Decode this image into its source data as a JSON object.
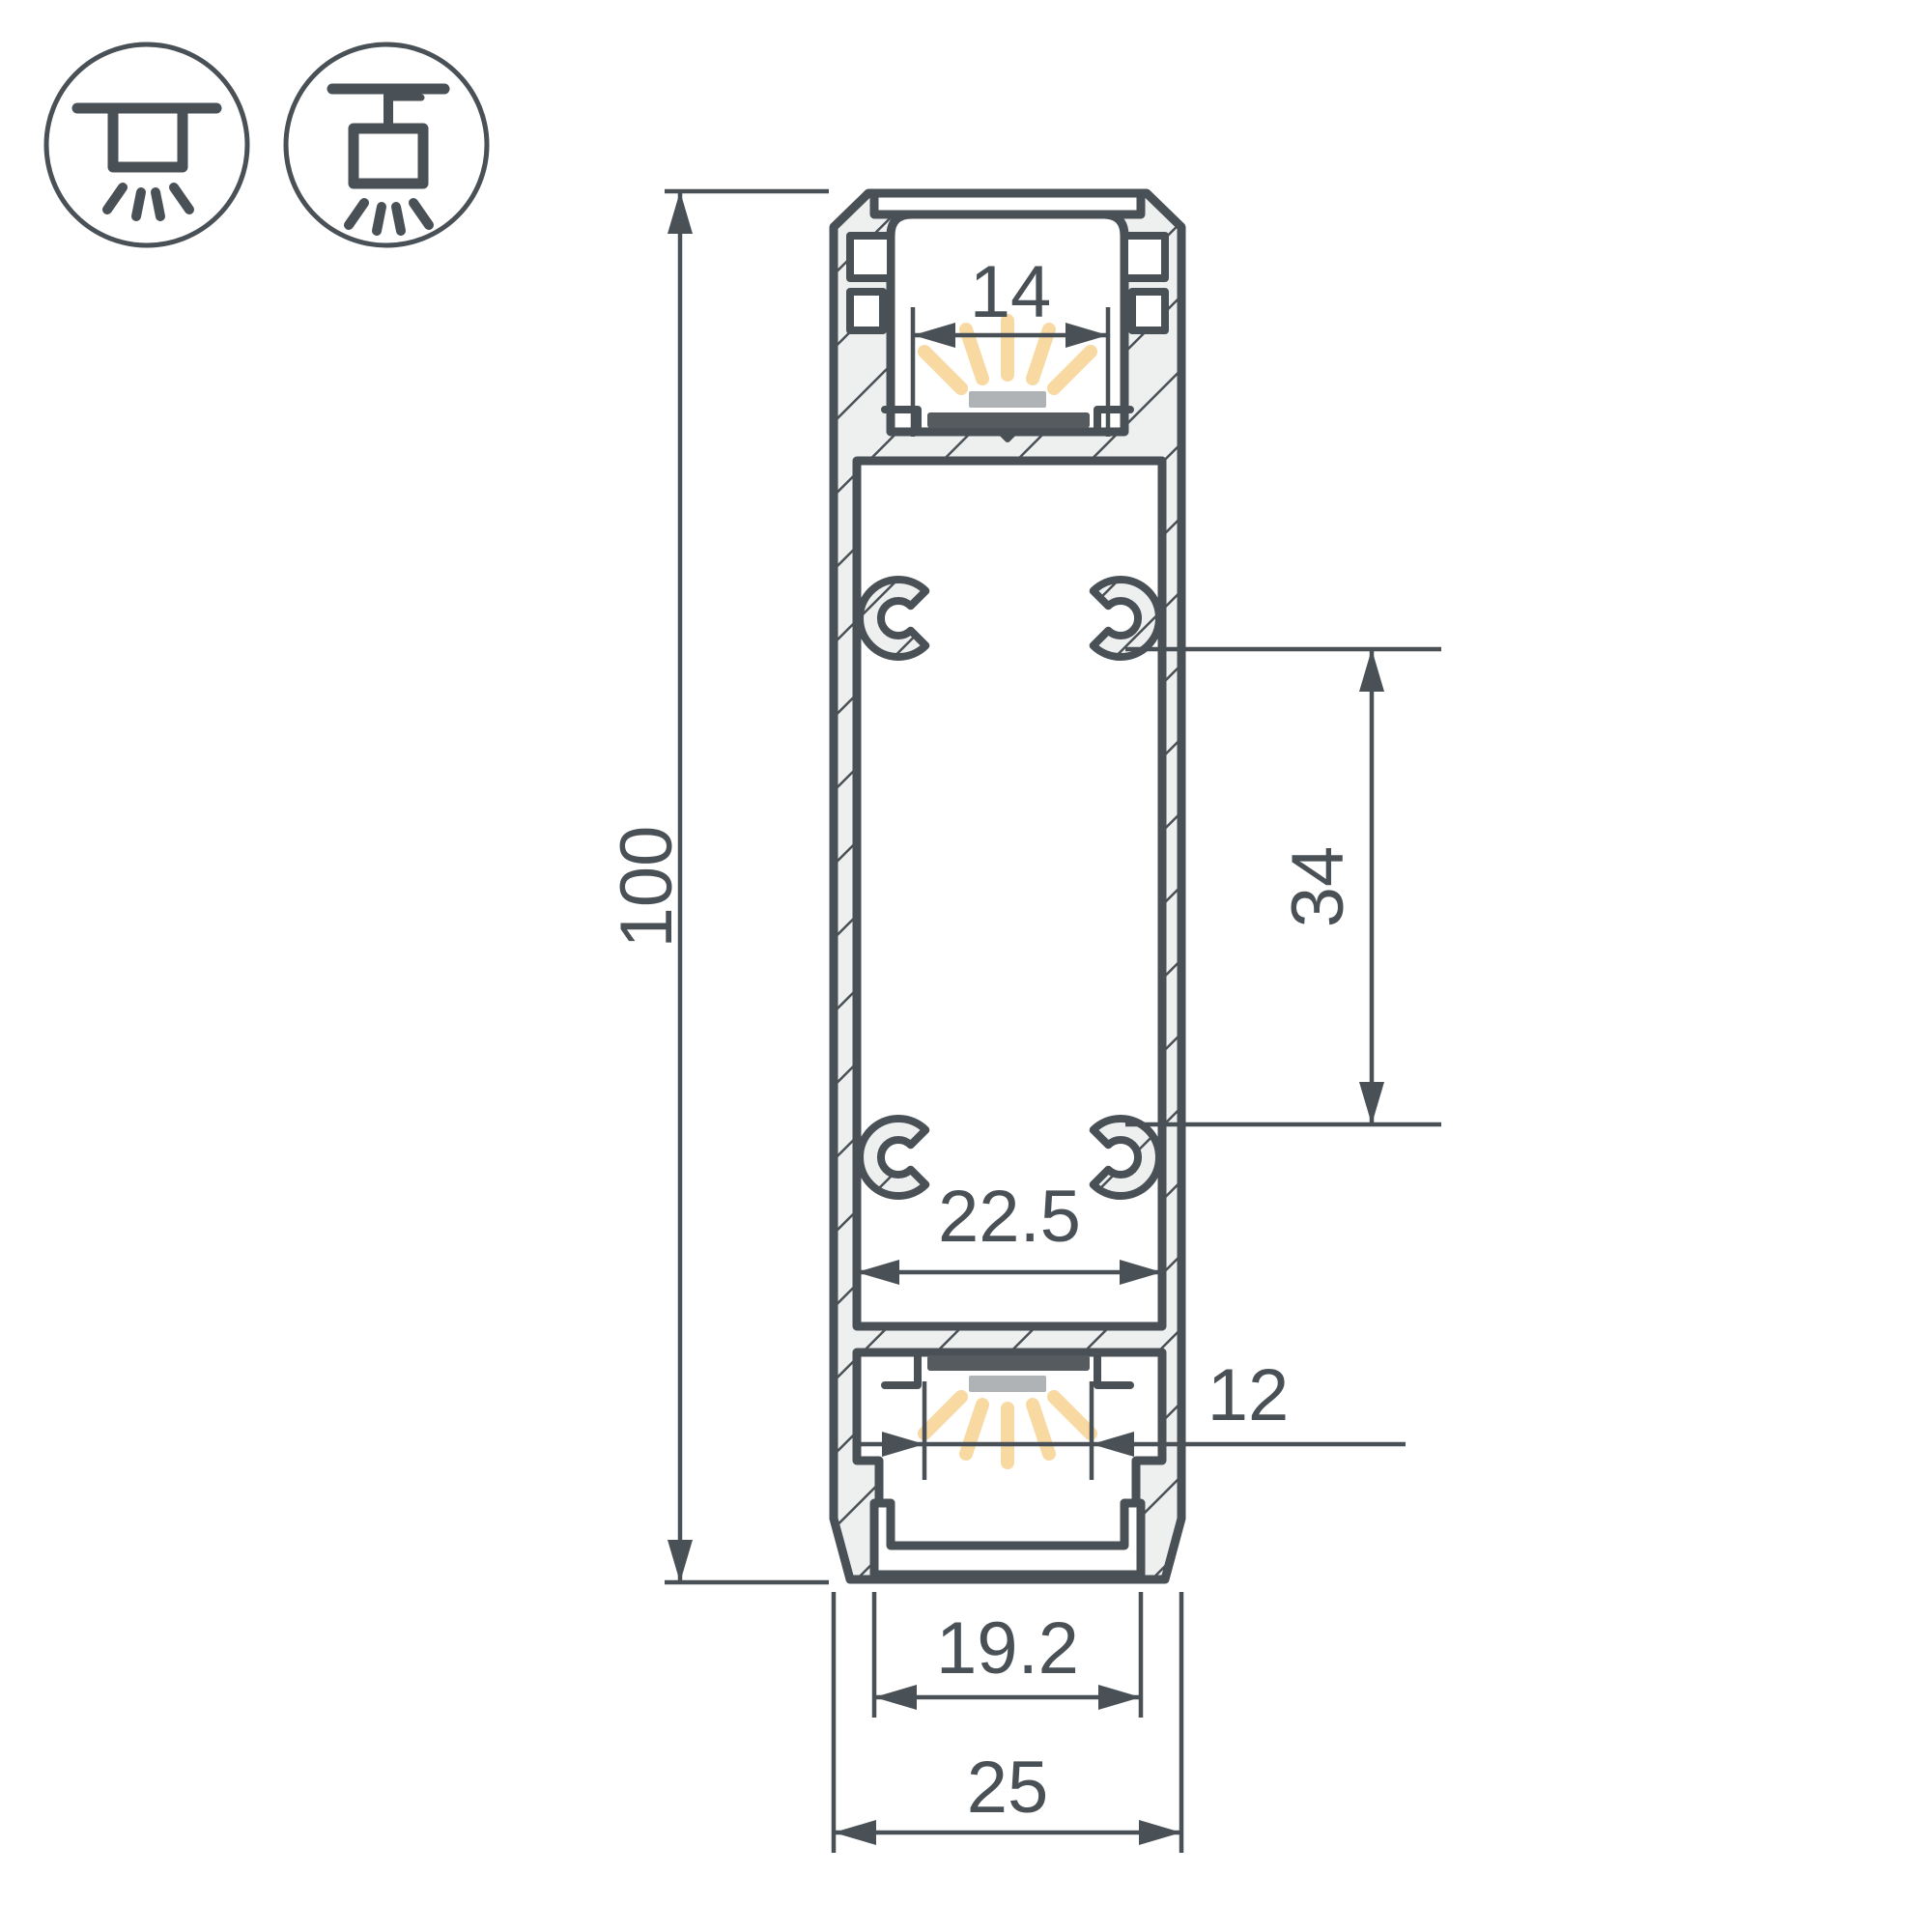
{
  "title": "LED profile cross-section dimension drawing",
  "icons": {
    "left": "recessed-ceiling-mount",
    "right": "pendant-ceiling-mount"
  },
  "dimensions": {
    "overall_height": "100",
    "top_window_width": "14",
    "boss_spacing": "34",
    "inner_width": "22.5",
    "led_slot_width": "12",
    "bottom_window_width": "19.2",
    "overall_width": "25"
  },
  "colors": {
    "line": "#4a5156",
    "hatch_fill": "#eef0f0",
    "led_glow": "#f8d9a2",
    "diffuser_gray": "#b0b3b5",
    "pcb_dark": "#565b60"
  }
}
